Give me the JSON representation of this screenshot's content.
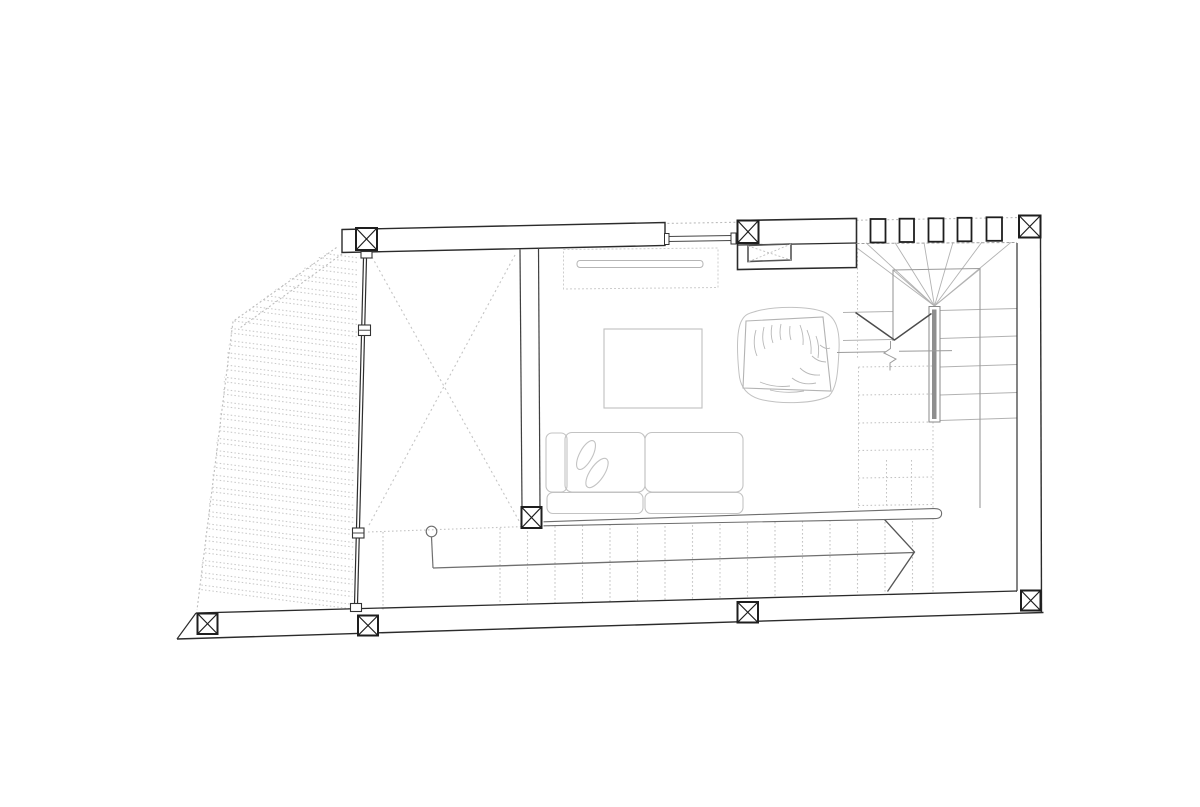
{
  "plan": {
    "colors": {
      "background": "#ffffff",
      "ink": "#1e1e1e",
      "wall": "#2b2b2b",
      "mid": "#6f6f6f",
      "arrow": "#565656",
      "vmark": "#4c4c4c",
      "break_line": "#9b9b9b",
      "stair_edge": "#9a9a9a",
      "light": "#b2b2b2",
      "faint": "#c6c6c6",
      "dots": "#c4c4c4",
      "rail_fill": "#8e8e8e"
    },
    "columns": [
      {
        "x": 356,
        "y": 228,
        "w": 21,
        "h": 22
      },
      {
        "x": 737.5,
        "y": 220.5,
        "w": 21,
        "h": 22.5
      },
      {
        "x": 1019,
        "y": 215.5,
        "w": 21.5,
        "h": 22
      },
      {
        "x": 521.5,
        "y": 507,
        "w": 20,
        "h": 21
      },
      {
        "x": 197.5,
        "y": 613.5,
        "w": 20,
        "h": 20.5
      },
      {
        "x": 358,
        "y": 615.5,
        "w": 20,
        "h": 20
      },
      {
        "x": 737.5,
        "y": 602,
        "w": 20.5,
        "h": 20.5
      },
      {
        "x": 1021,
        "y": 590.5,
        "w": 19.5,
        "h": 20
      }
    ],
    "mullions": [
      {
        "x": 870.5,
        "y": 219,
        "w": 15,
        "h": 23.5
      },
      {
        "x": 899.5,
        "y": 218.7,
        "w": 14.5,
        "h": 23.3
      },
      {
        "x": 928.5,
        "y": 218.3,
        "w": 15,
        "h": 23.4
      },
      {
        "x": 957.5,
        "y": 217.8,
        "w": 14,
        "h": 23.5
      },
      {
        "x": 986.5,
        "y": 217.3,
        "w": 15.5,
        "h": 23.5
      }
    ],
    "void_cross": [
      [
        372,
        257,
        523,
        528
      ],
      [
        515,
        255,
        368,
        527
      ]
    ],
    "hatch": {
      "x_left": 183,
      "x_right": 359,
      "y_start": 258,
      "count": 29,
      "step": 12.4,
      "pair_gap": 4.6,
      "slope": 0.128
    },
    "bottom_stair": {
      "top_edge": [
        368,
        532,
        940,
        512
      ],
      "treads_x": [
        500,
        527.5,
        555,
        582.5,
        610,
        637.5,
        665,
        692.5,
        720,
        747.5,
        775,
        802.5,
        830,
        857.5,
        885,
        912.5
      ],
      "tread_top_ref": [
        437,
        530.5,
        -0.0368
      ],
      "tread_bot_ref": [
        196,
        613,
        -0.0268
      ],
      "rail": [
        433,
        568,
        914,
        552.5
      ],
      "stem": [
        431.5,
        537,
        433,
        568
      ],
      "circle": {
        "cx": 431.5,
        "cy": 531.5,
        "r": 5.3
      },
      "arrow": "884.5,519.5 914.5,552 887.5,591.5",
      "left_dotted_v": [
        383,
        532,
        383,
        611
      ]
    },
    "winder": {
      "apex": [
        934.5,
        306
      ],
      "fan": [
        [
          857,
          248
        ],
        [
          866,
          242.8
        ],
        [
          895,
          242.6
        ],
        [
          924,
          242.4
        ],
        [
          953,
          242.2
        ],
        [
          982,
          242
        ],
        [
          1011,
          242.3
        ],
        [
          893,
          270
        ],
        [
          980,
          269
        ]
      ],
      "right_treads": [
        [
          940,
          310.5,
          1017,
          308.5
        ],
        [
          940,
          338.5,
          1017,
          336
        ],
        [
          940,
          367,
          1017,
          364.5
        ],
        [
          940,
          395,
          1017,
          392.5
        ],
        [
          940,
          420.5,
          1017,
          418
        ]
      ],
      "left_treads": [
        [
          843,
          312.5,
          893,
          311.5
        ],
        [
          843,
          340.5,
          893,
          339.5
        ]
      ],
      "square": "893,341 893,270 980,268.5 980,508",
      "hidden_cols": [
        [
          858.5,
          367,
          858.5,
          508
        ],
        [
          886.5,
          460,
          886.5,
          508
        ],
        [
          911.5,
          460,
          911.5,
          508
        ],
        [
          933,
          422,
          933,
          508
        ],
        [
          857.5,
          248,
          857.5,
          360
        ],
        [
          933,
          514,
          933,
          594
        ]
      ],
      "hidden_rows": [
        [
          858.5,
          367,
          933,
          366
        ],
        [
          858.5,
          395,
          933,
          394
        ],
        [
          858.5,
          423,
          933,
          422
        ],
        [
          858.5,
          450.5,
          933,
          449.5
        ],
        [
          858.5,
          478,
          933,
          477
        ],
        [
          858.5,
          505.5,
          933,
          504.5
        ]
      ]
    }
  }
}
